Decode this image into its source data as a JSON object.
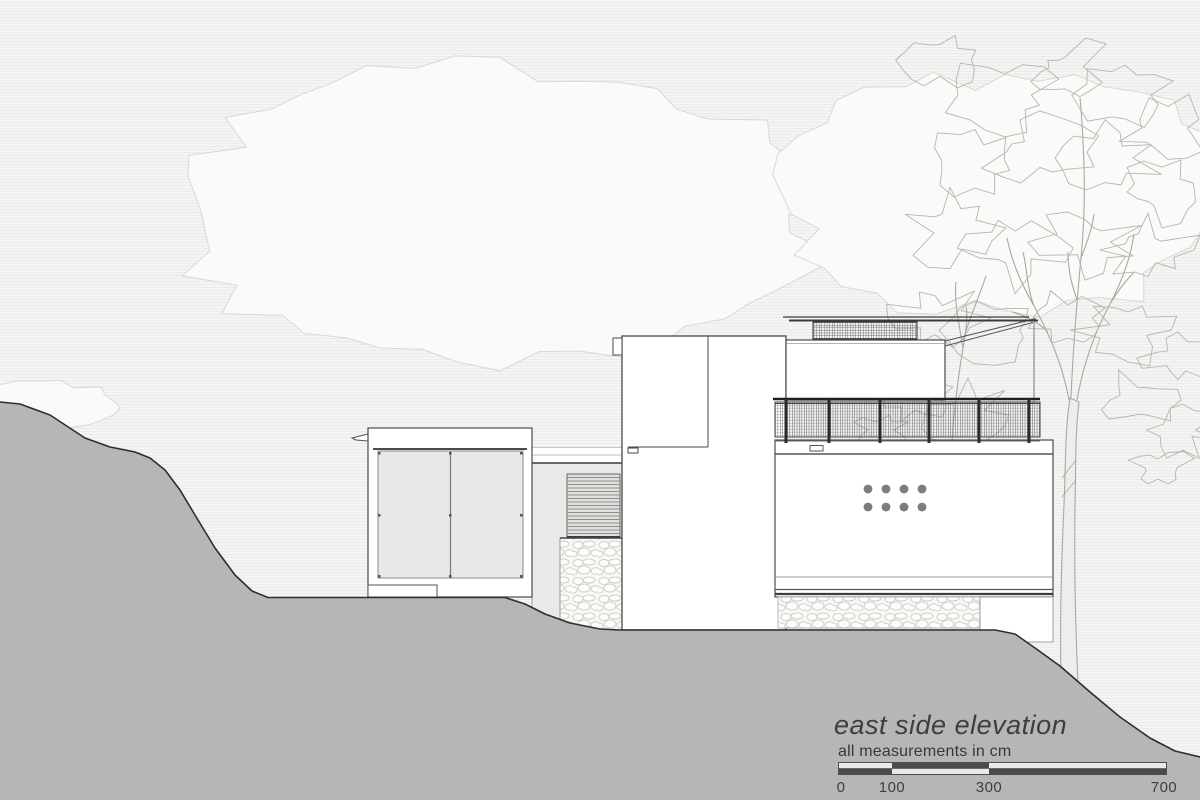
{
  "title_block": {
    "title": "east side elevation",
    "note": "all measurements in cm"
  },
  "scale_bar": {
    "unit": "cm",
    "values": [
      0,
      100,
      300,
      700
    ],
    "tick_labels": [
      "0",
      "100",
      "300",
      "700"
    ]
  },
  "colors": {
    "terrain": "#b6b6b4",
    "outline": "#4a4a4a",
    "glass": "#e8e8e7",
    "vent_dot": "#7d7d7d",
    "background": "#f4f4f2"
  }
}
